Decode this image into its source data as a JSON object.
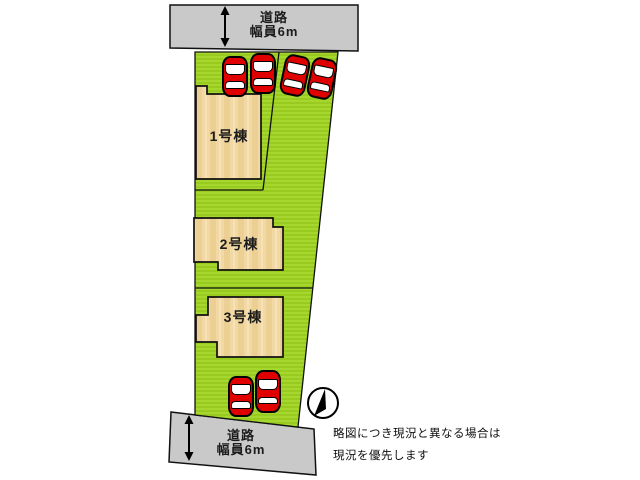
{
  "plan": {
    "type": "property-site-plan",
    "buildings": [
      {
        "label": "1号棟"
      },
      {
        "label": "2号棟"
      },
      {
        "label": "3号棟"
      }
    ],
    "roads": {
      "top": {
        "line1": "道路",
        "line2": "幅員6m"
      },
      "bottom": {
        "line1": "道路",
        "line2": "幅員6m"
      }
    },
    "note": {
      "line1": "略図につき現況と異なる場合は",
      "line2": "現況を優先します"
    },
    "cars": {
      "count": 6,
      "color": "#e10000"
    },
    "colors": {
      "plot_green": "#a3d52c",
      "plot_green_stripe": "#97c91e",
      "building_tan": "#f1d8a4",
      "road_gray": "#c9c9c9",
      "outline": "#111111"
    }
  }
}
